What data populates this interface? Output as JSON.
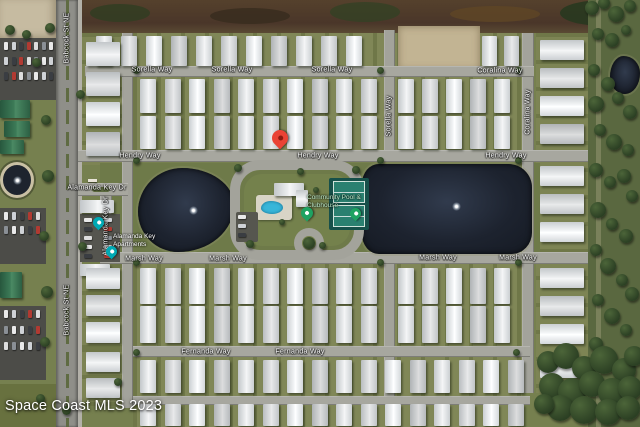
{
  "map": {
    "watermark": "Space Coast MLS 2023",
    "street_labels": [
      {
        "text": "Sorella Way",
        "x": 152,
        "y": 70,
        "rot": 0
      },
      {
        "text": "Sorella Way",
        "x": 232,
        "y": 70,
        "rot": 0
      },
      {
        "text": "Sorella Way",
        "x": 332,
        "y": 70,
        "rot": 0
      },
      {
        "text": "Coralina Way",
        "x": 500,
        "y": 71,
        "rot": 0
      },
      {
        "text": "Hendry Way",
        "x": 140,
        "y": 156,
        "rot": 0
      },
      {
        "text": "Hendry Way",
        "x": 318,
        "y": 156,
        "rot": 0
      },
      {
        "text": "Hendry Way",
        "x": 506,
        "y": 156,
        "rot": 0
      },
      {
        "text": "Marsh Way",
        "x": 144,
        "y": 259,
        "rot": 0
      },
      {
        "text": "Marsh Way",
        "x": 228,
        "y": 259,
        "rot": 0
      },
      {
        "text": "Marsh Way",
        "x": 438,
        "y": 258,
        "rot": 0
      },
      {
        "text": "Marsh Way",
        "x": 518,
        "y": 258,
        "rot": 0
      },
      {
        "text": "Fernanda Way",
        "x": 206,
        "y": 352,
        "rot": 0
      },
      {
        "text": "Fernanda Way",
        "x": 300,
        "y": 352,
        "rot": 0
      },
      {
        "text": "Alamanda Key Dr",
        "x": 97,
        "y": 188,
        "rot": 0
      },
      {
        "text": "Alamanda Key Dr",
        "x": 106,
        "y": 226,
        "rot": 90
      },
      {
        "text": "Babcock St NE",
        "x": 67,
        "y": 38,
        "rot": 90
      },
      {
        "text": "Babcock St NE",
        "x": 67,
        "y": 310,
        "rot": 90
      },
      {
        "text": "Coralina Way",
        "x": 528,
        "y": 112,
        "rot": 90
      },
      {
        "text": "Sorella Way",
        "x": 389,
        "y": 116,
        "rot": 90
      }
    ],
    "poi_labels": [
      {
        "lines": [
          "Alamanda Key",
          "Apartments"
        ],
        "x": 113,
        "y": 233,
        "color": "#ffffff"
      },
      {
        "lines": [
          "Community Pool &",
          "Clubhouse"
        ],
        "x": 307,
        "y": 194,
        "color": "#b9e6c6"
      }
    ],
    "pins": [
      {
        "name": "property-marker-pin",
        "x": 272,
        "y": 130,
        "color": "#EA4335",
        "dot": "#8C1A10",
        "size": 16
      },
      {
        "name": "poi-pin-teal-1",
        "x": 93,
        "y": 217,
        "color": "#00A9B4",
        "dot": "#ffffff",
        "size": 11
      },
      {
        "name": "poi-pin-teal-2",
        "x": 106,
        "y": 246,
        "color": "#00A9B4",
        "dot": "#ffffff",
        "size": 11
      },
      {
        "name": "poi-pin-green-pool",
        "x": 301,
        "y": 207,
        "color": "#1EA362",
        "dot": "#ffffff",
        "size": 12
      },
      {
        "name": "poi-pin-green-courts",
        "x": 350,
        "y": 208,
        "color": "#1EA362",
        "dot": "#ffffff",
        "size": 11
      }
    ],
    "colors": {
      "water": "#1D232F",
      "pool": "#38B6D9",
      "tennis_court": "#2A8070",
      "roof": "#ECEEEF",
      "green_roof": "#3C7A57",
      "road": "#A7A79F",
      "grass": "#76804F",
      "scrub": "#4A3629",
      "dirt": "#C6BBA1",
      "pin_red": "#EA4335",
      "pin_teal": "#00A9B4",
      "pin_green": "#1EA362",
      "label_text": "#FFFFFF",
      "amenity_label_text": "#B9E6C6"
    }
  }
}
